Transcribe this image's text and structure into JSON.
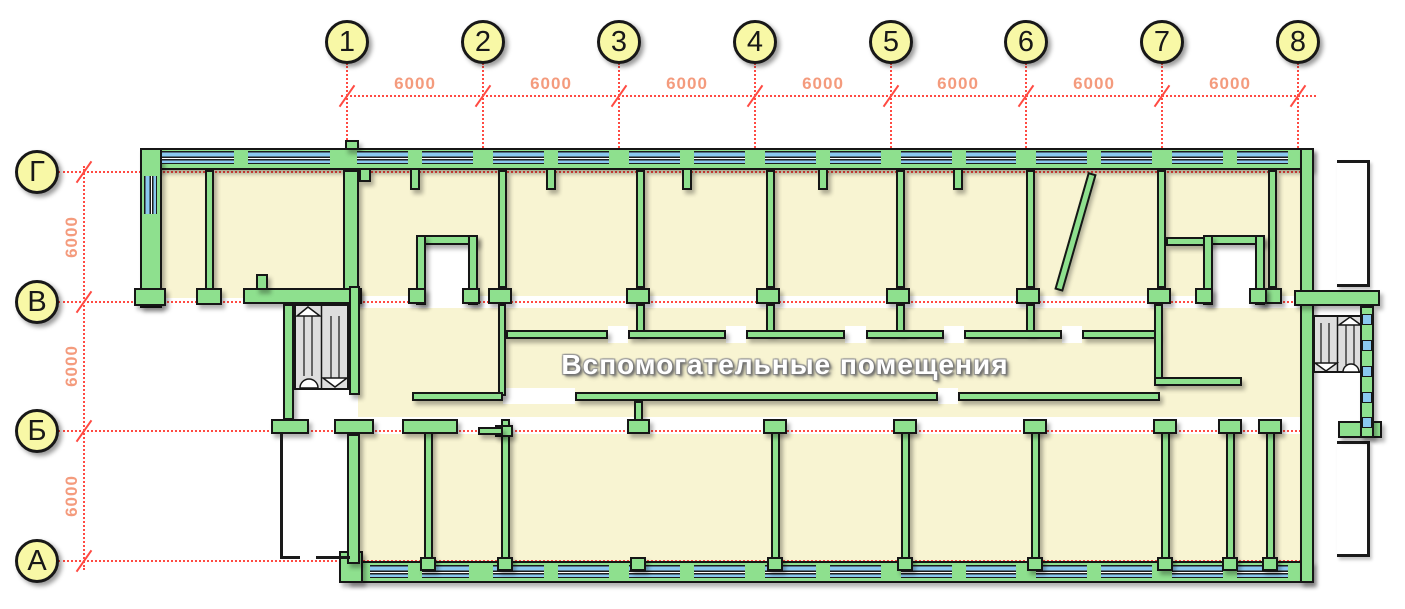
{
  "axes": {
    "cols": [
      {
        "label": "1",
        "x": 347
      },
      {
        "label": "2",
        "x": 483
      },
      {
        "label": "3",
        "x": 619
      },
      {
        "label": "4",
        "x": 755
      },
      {
        "label": "5",
        "x": 891
      },
      {
        "label": "6",
        "x": 1026
      },
      {
        "label": "7",
        "x": 1162
      },
      {
        "label": "8",
        "x": 1298
      }
    ],
    "rows": [
      {
        "label": "Г",
        "y": 172
      },
      {
        "label": "В",
        "y": 302
      },
      {
        "label": "Б",
        "y": 431
      },
      {
        "label": "А",
        "y": 561
      }
    ]
  },
  "dims": {
    "top": [
      "6000",
      "6000",
      "6000",
      "6000",
      "6000",
      "6000",
      "6000"
    ],
    "left": [
      "6000",
      "6000",
      "6000"
    ]
  },
  "corridor_label": "Вспомогательные помещения",
  "colors": {
    "wall_green": "#8ee08e",
    "window_blue": "#8ac8ef",
    "room_cream": "#f8f4d2",
    "grid_red": "#ff4a42",
    "dim_salmon": "#f49b7d",
    "axis_fill": "#f8f8a6",
    "stair_gray": "#dedede"
  }
}
